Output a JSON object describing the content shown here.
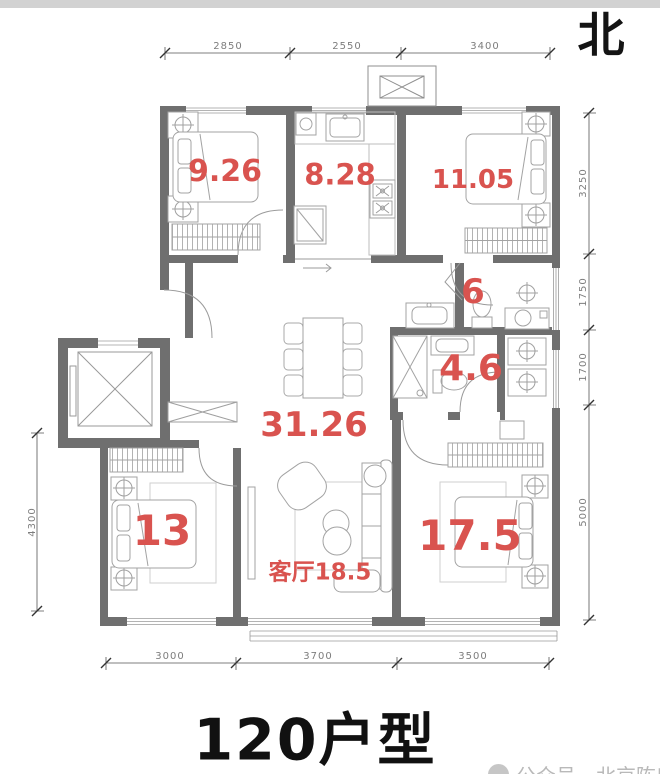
{
  "compass": {
    "label": "北"
  },
  "title": {
    "text": "120户型"
  },
  "watermark": {
    "text": "公众号—北京陈房子"
  },
  "rooms": [
    {
      "name": "bedroom-northwest",
      "area": "9.26"
    },
    {
      "name": "kitchen",
      "area": "8.28"
    },
    {
      "name": "bedroom-northeast",
      "area": "11.05"
    },
    {
      "name": "bathroom-north",
      "area": "6"
    },
    {
      "name": "bathroom-south",
      "area": "4.6"
    },
    {
      "name": "dining-hall",
      "area": "31.26"
    },
    {
      "name": "bedroom-southwest",
      "area": "13"
    },
    {
      "name": "living-room",
      "area": "客厅18.5"
    },
    {
      "name": "bedroom-southeast",
      "area": "17.5"
    }
  ],
  "dimensions": {
    "top": [
      "2850",
      "2550",
      "3400"
    ],
    "bottom": [
      "3000",
      "3700",
      "3500"
    ],
    "left": [
      "4300"
    ],
    "right": [
      "3250",
      "1750",
      "1700",
      "5000"
    ]
  },
  "colors": {
    "area_label": "#d9534f",
    "wall": "#6f6f6f",
    "dimension_text": "#7d7d7d",
    "title": "#111111",
    "watermark": "#b9b9b9",
    "top_strip": "#d2d2d2"
  }
}
